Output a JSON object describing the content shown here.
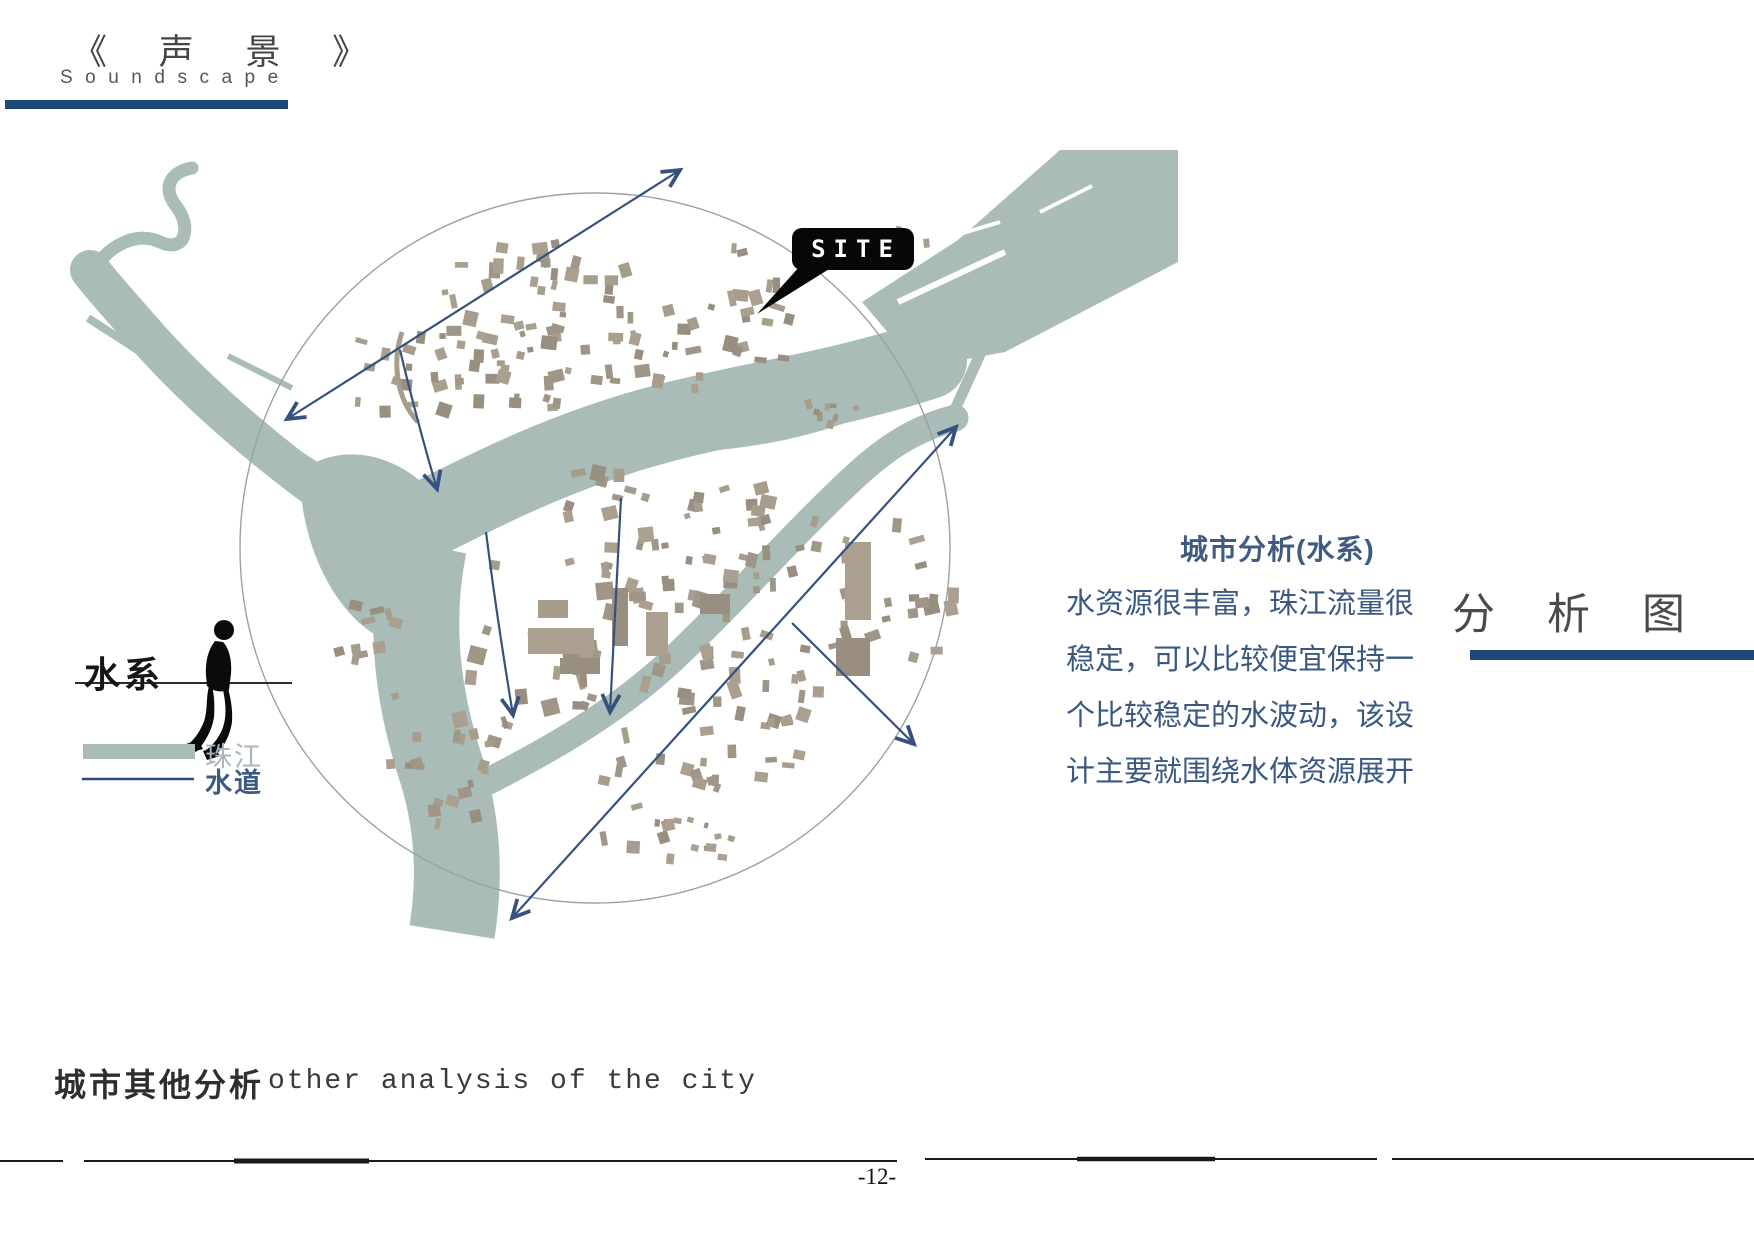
{
  "header": {
    "title_cn": "《 声 景 》",
    "title_en": "Soundscape"
  },
  "map": {
    "site_label": "SITE",
    "water_legend": {
      "section_label": "水系",
      "items": [
        {
          "label": "珠江",
          "swatch": "thick-river-bar"
        },
        {
          "label": "水道",
          "swatch": "thin-waterway-line"
        }
      ]
    }
  },
  "analysis_text": {
    "heading": "城市分析(水系)",
    "lines": [
      "水资源很丰富，珠江流量很",
      "稳定，可以比较便宜保持一",
      "个比较稳定的水波动，该设",
      "计主要就围绕水体资源展开"
    ]
  },
  "section_title": "分析图",
  "caption": {
    "cn": "城市其他分析",
    "en": "other analysis of the city"
  },
  "footer": {
    "page_number": "-12-"
  },
  "colors": {
    "accent_bar": "#1d4877",
    "water": "#a9bcb8",
    "building_palette": [
      "#a79d8c",
      "#9f9688",
      "#ab9f90",
      "#998f80"
    ],
    "arrow": "#35517c",
    "analysis_text": "#3b5880",
    "legend_zhujiang_label": "#a8b5bf",
    "legend_shuidao_label": "#3c5a82"
  }
}
